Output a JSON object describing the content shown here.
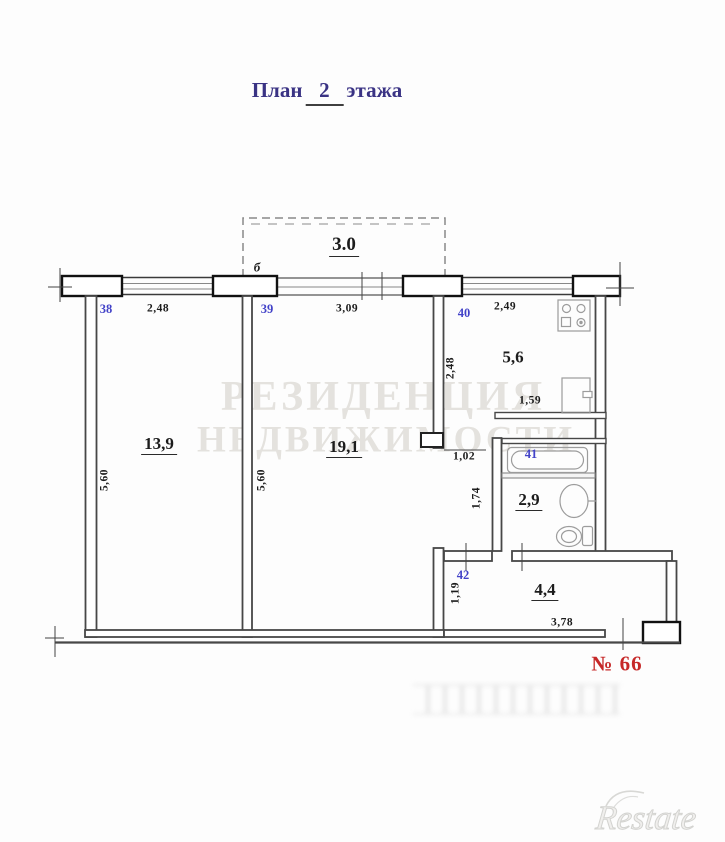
{
  "title": {
    "word1": "План",
    "floor": "2",
    "word2": "этажа"
  },
  "unit_label": "№ 66",
  "balcony": {
    "area": "3.0",
    "door_marker": "б"
  },
  "rooms": [
    {
      "number": "38",
      "area": "13,9"
    },
    {
      "number": "39",
      "area": "19,1"
    },
    {
      "number": "40",
      "area": "5,6"
    },
    {
      "number": "41",
      "area": "2,9"
    },
    {
      "number": "42",
      "area": "4,4"
    }
  ],
  "dimensions": [
    {
      "value": "2,48"
    },
    {
      "value": "3,09"
    },
    {
      "value": "2,49"
    },
    {
      "value": "5,60"
    },
    {
      "value": "5,60"
    },
    {
      "value": "2,48"
    },
    {
      "value": "1,59"
    },
    {
      "value": "1,02"
    },
    {
      "value": "1,74"
    },
    {
      "value": "1,19"
    },
    {
      "value": "3,78"
    }
  ],
  "watermark": {
    "line1": "РЕЗИДЕНЦИЯ",
    "line2": "НЕДВИЖИМОСТИ",
    "logo": "Restate"
  },
  "colors": {
    "title": "#3a3384",
    "room_number": "#4242c8",
    "unit_label": "#c62828",
    "walls": "#474747",
    "watermark": "#e4e2de"
  }
}
